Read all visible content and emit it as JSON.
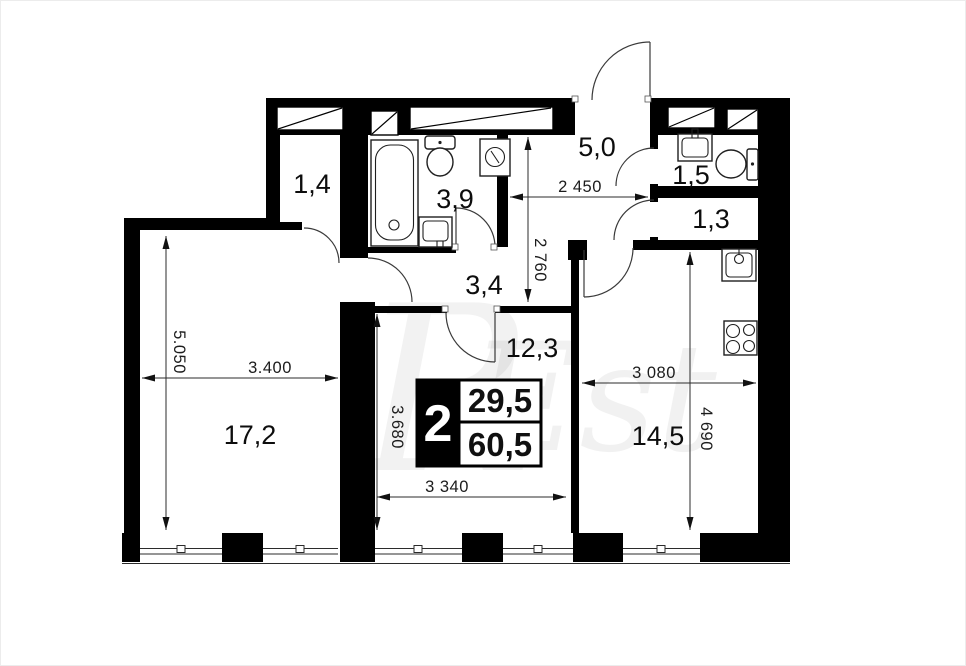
{
  "title": "apartment-floor-plan",
  "watermark": {
    "monogram": "R",
    "text": "Est"
  },
  "rooms": [
    {
      "name": "closet",
      "area": "1,4"
    },
    {
      "name": "bathroom",
      "area": "3,9"
    },
    {
      "name": "entry-hall",
      "area": "5,0"
    },
    {
      "name": "wc",
      "area": "1,5"
    },
    {
      "name": "storage",
      "area": "1,3"
    },
    {
      "name": "corridor",
      "area": "3,4"
    },
    {
      "name": "bedroom",
      "area": "12,3"
    },
    {
      "name": "living-room",
      "area": "17,2"
    },
    {
      "name": "kitchen",
      "area": "14,5"
    }
  ],
  "dimensions": {
    "living_height": "5.050",
    "living_width": "3.400",
    "hall_width": "2 450",
    "hall_height": "2 760",
    "kitchen_width": "3 080",
    "kitchen_height": "4 690",
    "bedroom_height": "3.680",
    "bedroom_width": "3 340"
  },
  "info_box": {
    "rooms_count": "2",
    "living_area": "29,5",
    "total_area": "60,5"
  },
  "colors": {
    "walls": "#000000",
    "background": "#ffffff",
    "lines": "#2b2b2b",
    "watermark": "#e6e6e6"
  }
}
